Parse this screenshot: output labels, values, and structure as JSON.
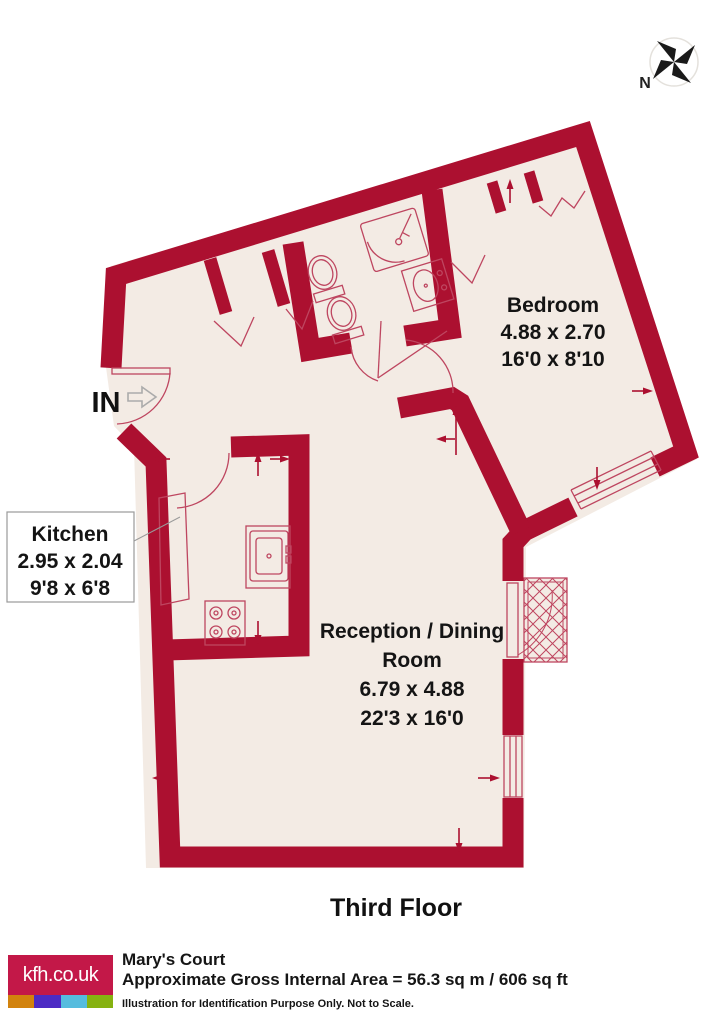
{
  "colors": {
    "wall": "#AC1030",
    "floor": "#F3EBE4",
    "fixture": "#BE4660",
    "label_border": "#9A9A9A",
    "compass": "#1A1A1A",
    "in_arrow": "#ABABAB",
    "logo_bg": "#C31848",
    "strip_orange": "#D2830E",
    "strip_purple": "#4C2BC4",
    "strip_blue": "#55BCDE",
    "strip_green": "#86B210"
  },
  "plan": {
    "floor_label": "Third Floor",
    "entrance_label": "IN",
    "compass_label": "N",
    "rooms": {
      "bedroom": {
        "name": "Bedroom",
        "metric": "4.88 x 2.70",
        "imperial": "16'0 x 8'10"
      },
      "kitchen": {
        "name": "Kitchen",
        "metric": "2.95 x 2.04",
        "imperial": "9'8 x 6'8"
      },
      "reception": {
        "name_line1": "Reception / Dining",
        "name_line2": "Room",
        "metric": "6.79 x 4.88",
        "imperial": "22'3 x 16'0"
      }
    }
  },
  "footer": {
    "logo_text": "kfh.co.uk",
    "property_name": "Mary's Court",
    "area_line": "Approximate Gross Internal Area = 56.3 sq m / 606 sq ft",
    "disclaimer": "Illustration for Identification Purpose Only. Not to Scale."
  }
}
